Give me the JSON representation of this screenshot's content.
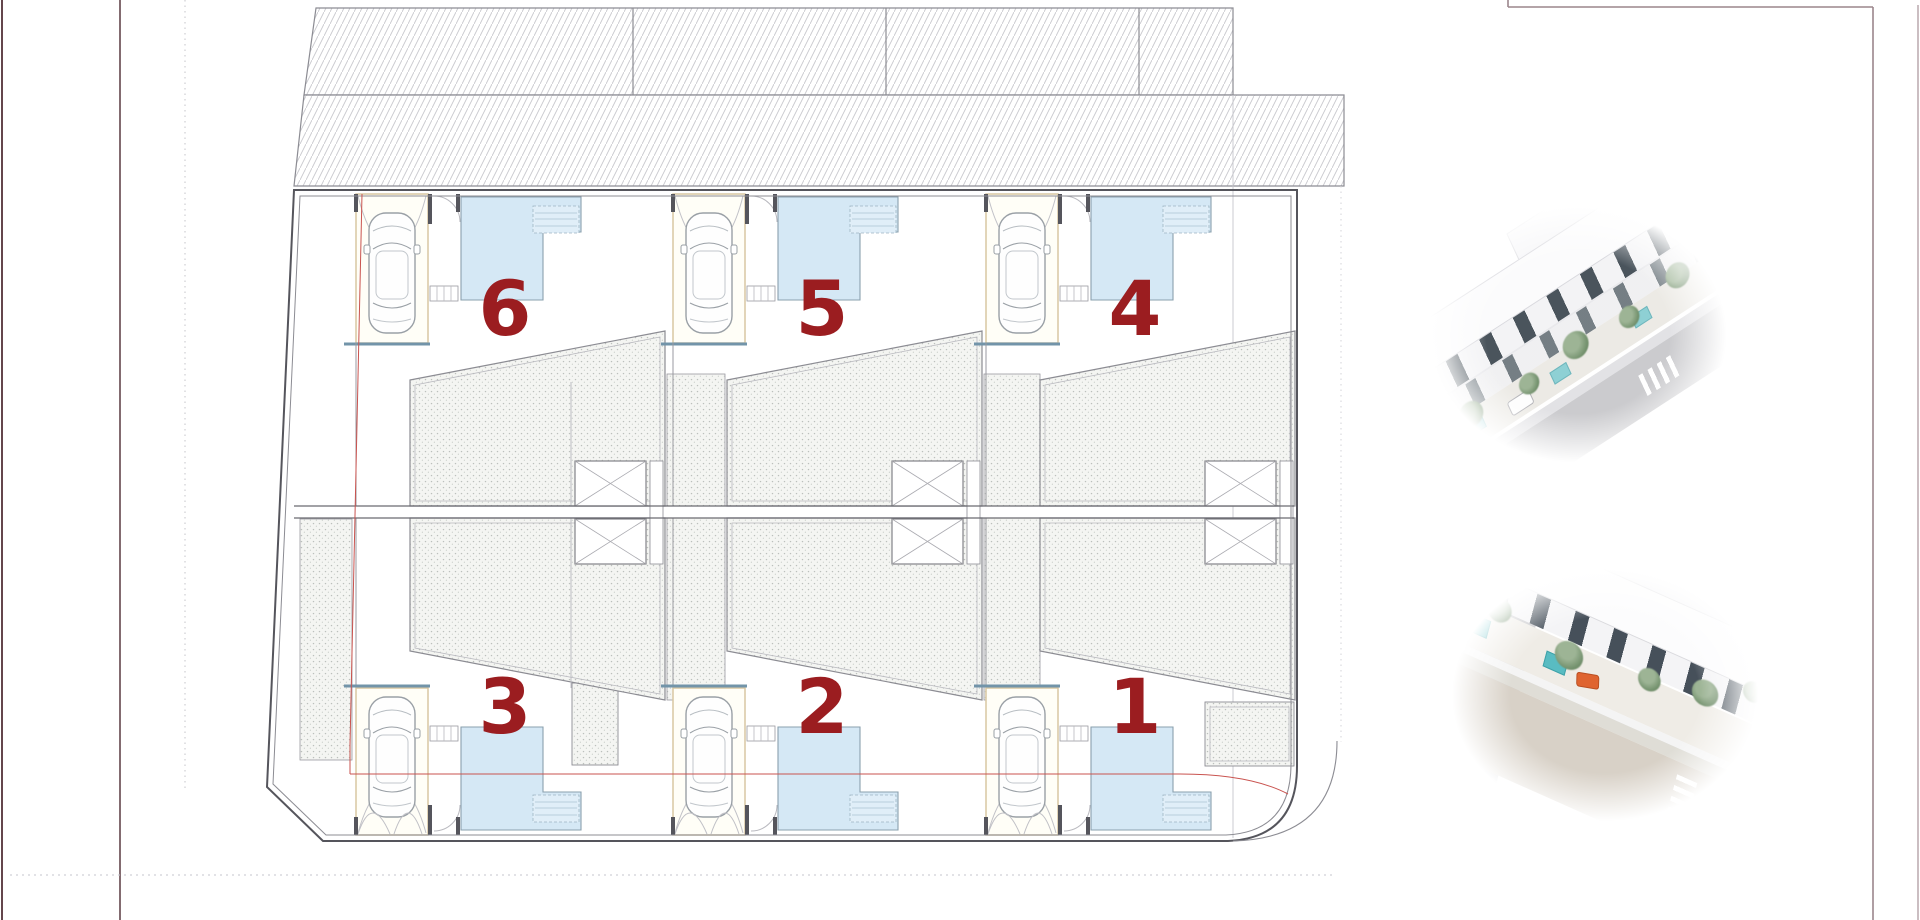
{
  "plan": {
    "units": [
      {
        "label": "6"
      },
      {
        "label": "5"
      },
      {
        "label": "4"
      },
      {
        "label": "3"
      },
      {
        "label": "2"
      },
      {
        "label": "1"
      }
    ],
    "colors": {
      "unit_number": "#9b1d20",
      "pool_fill": "#d5e8f5",
      "pool_coping": "#7294a9",
      "parking_outline": "#d9c7a2",
      "boundary_red": "#c9534f",
      "wall": "#55555c",
      "site_line_maroon": "#64464c"
    },
    "icons": {
      "car-icon": "top-view-car-outline",
      "pool-icon": "l-shaped-pool",
      "skylight-icon": "x-crossed-box",
      "hatch-icon": "diagonal-line-hatch"
    }
  },
  "renders": [
    {
      "name": "exterior-render-top"
    },
    {
      "name": "exterior-render-bottom"
    }
  ]
}
